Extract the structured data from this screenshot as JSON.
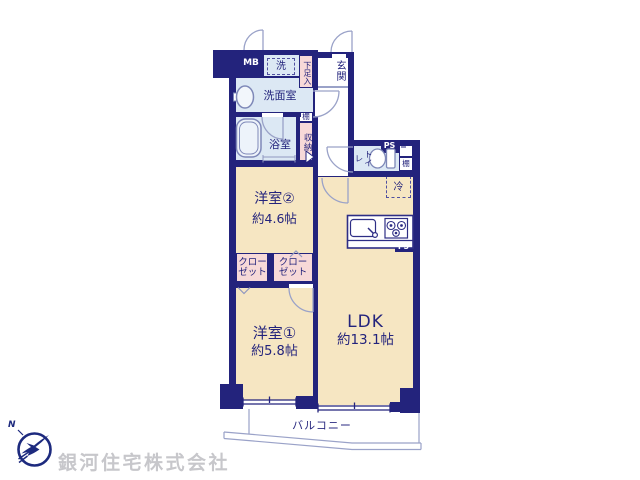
{
  "plan": {
    "colors": {
      "wall": "#23237c",
      "room_cream": "#f6e6c2",
      "wet_blue": "#dce8f4",
      "storage_pink": "#f7d9d8",
      "fixture_line": "#7e88b8",
      "door_arc": "#9aa2c8",
      "company_gray": "#c7c7cb"
    },
    "rooms": {
      "ldk": {
        "label": "LDK",
        "size": "約13.1帖"
      },
      "room1": {
        "label": "洋室①",
        "size": "約5.8帖"
      },
      "room2": {
        "label": "洋室②",
        "size": "約4.6帖"
      },
      "washroom": {
        "label": "洗面室"
      },
      "bathroom": {
        "label": "浴室"
      },
      "toilet": {
        "label": "トイレ"
      },
      "entrance": {
        "label": "玄関"
      },
      "balcony": {
        "label": "バルコニー"
      }
    },
    "features": {
      "meter_box": "MB",
      "washer": "洗",
      "shoe_cabinet": "下足入",
      "shelf_upper": "棚",
      "shelf_toilet": "棚",
      "storage": "収納",
      "closet_left": {
        "line1": "クロー",
        "line2": "ゼット"
      },
      "closet_right": {
        "line1": "クロー",
        "line2": "ゼット"
      },
      "fridge": "冷",
      "ps_toilet": "PS",
      "ps_kitchen": "PS"
    }
  },
  "footer": {
    "company": "銀河住宅株式会社",
    "compass": "N"
  }
}
